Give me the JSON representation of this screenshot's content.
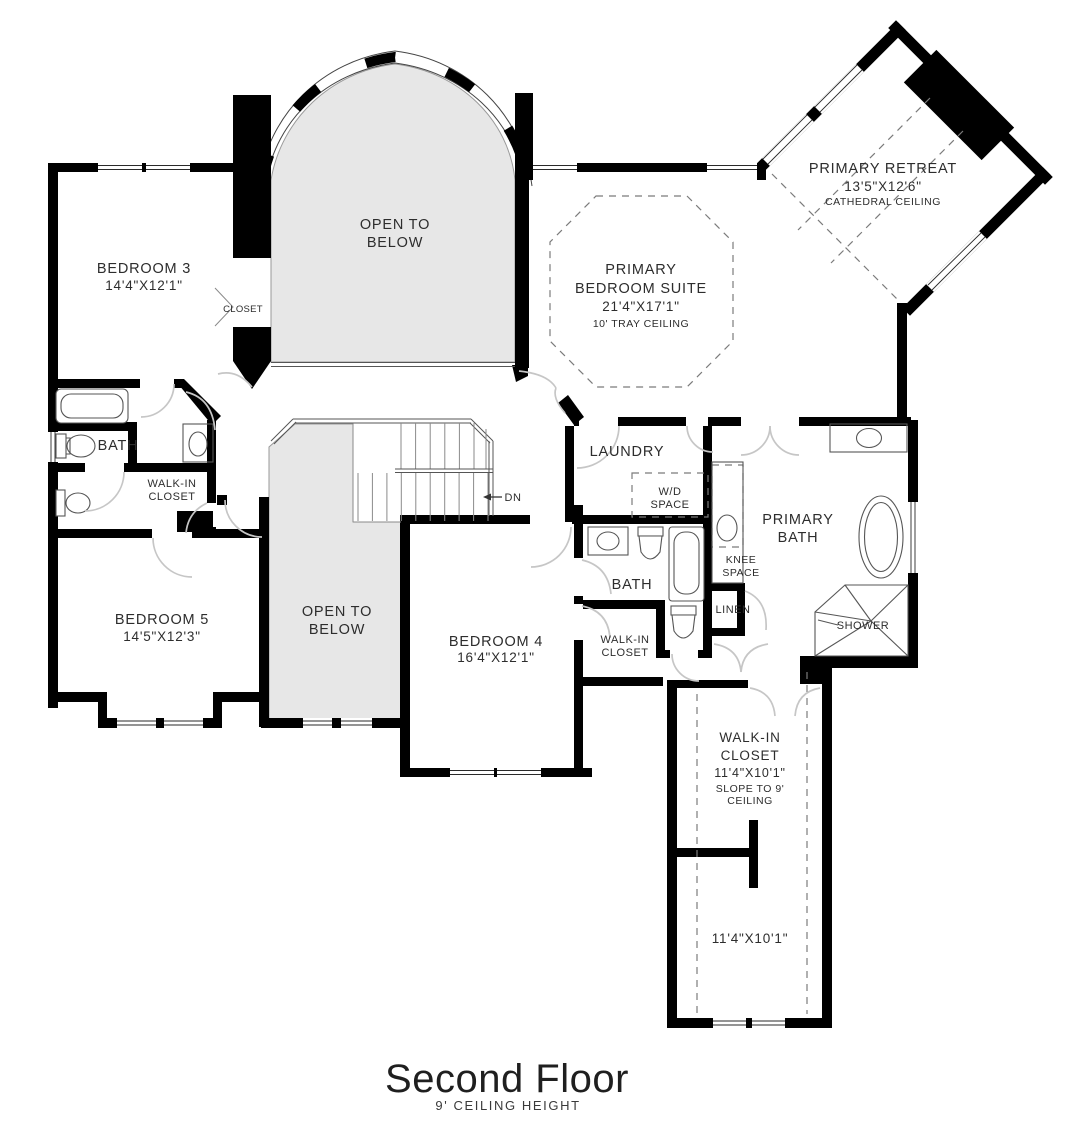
{
  "colors": {
    "wall": "#000000",
    "open_below_fill": "#e7e7e7",
    "door_arc": "#c6c6c6",
    "dashed": "#7b7b7b",
    "fixture": "#565656",
    "text": "#2d2d2d"
  },
  "labels": {
    "bedroom3_name": "BEDROOM 3",
    "bedroom3_dims": "14'4\"X12'1\"",
    "closet3": "CLOSET",
    "open_below_top_1": "OPEN TO",
    "open_below_top_2": "BELOW",
    "open_below_mid_1": "OPEN TO",
    "open_below_mid_2": "BELOW",
    "suite_1": "PRIMARY",
    "suite_2": "BEDROOM SUITE",
    "suite_dims": "21'4\"X17'1\"",
    "suite_ceiling": "10' TRAY CEILING",
    "retreat_name": "PRIMARY RETREAT",
    "retreat_dims": "13'5\"X12'6\"",
    "retreat_ceiling": "CATHEDRAL CEILING",
    "bath3": "BATH",
    "wic5_1": "WALK-IN",
    "wic5_2": "CLOSET",
    "bedroom5_name": "BEDROOM 5",
    "bedroom5_dims": "14'5\"X12'3\"",
    "laundry": "LAUNDRY",
    "wd_1": "W/D",
    "wd_2": "SPACE",
    "primary_bath_1": "PRIMARY",
    "primary_bath_2": "BATH",
    "knee_1": "KNEE",
    "knee_2": "SPACE",
    "bath4": "BATH",
    "linen": "LINEN",
    "shower": "SHOWER",
    "bedroom4_name": "BEDROOM 4",
    "bedroom4_dims": "16'4\"X12'1\"",
    "wic4_1": "WALK-IN",
    "wic4_2": "CLOSET",
    "wicp_1": "WALK-IN",
    "wicp_2": "CLOSET",
    "wicp_dims": "11'4\"X10'1\"",
    "wicp_slope_1": "SLOPE TO 9'",
    "wicp_slope_2": "CEILING",
    "wicp_dims_lower": "11'4\"X10'1\"",
    "stairs_dn": "DN",
    "title": "Second Floor",
    "subtitle": "9' CEILING HEIGHT"
  }
}
